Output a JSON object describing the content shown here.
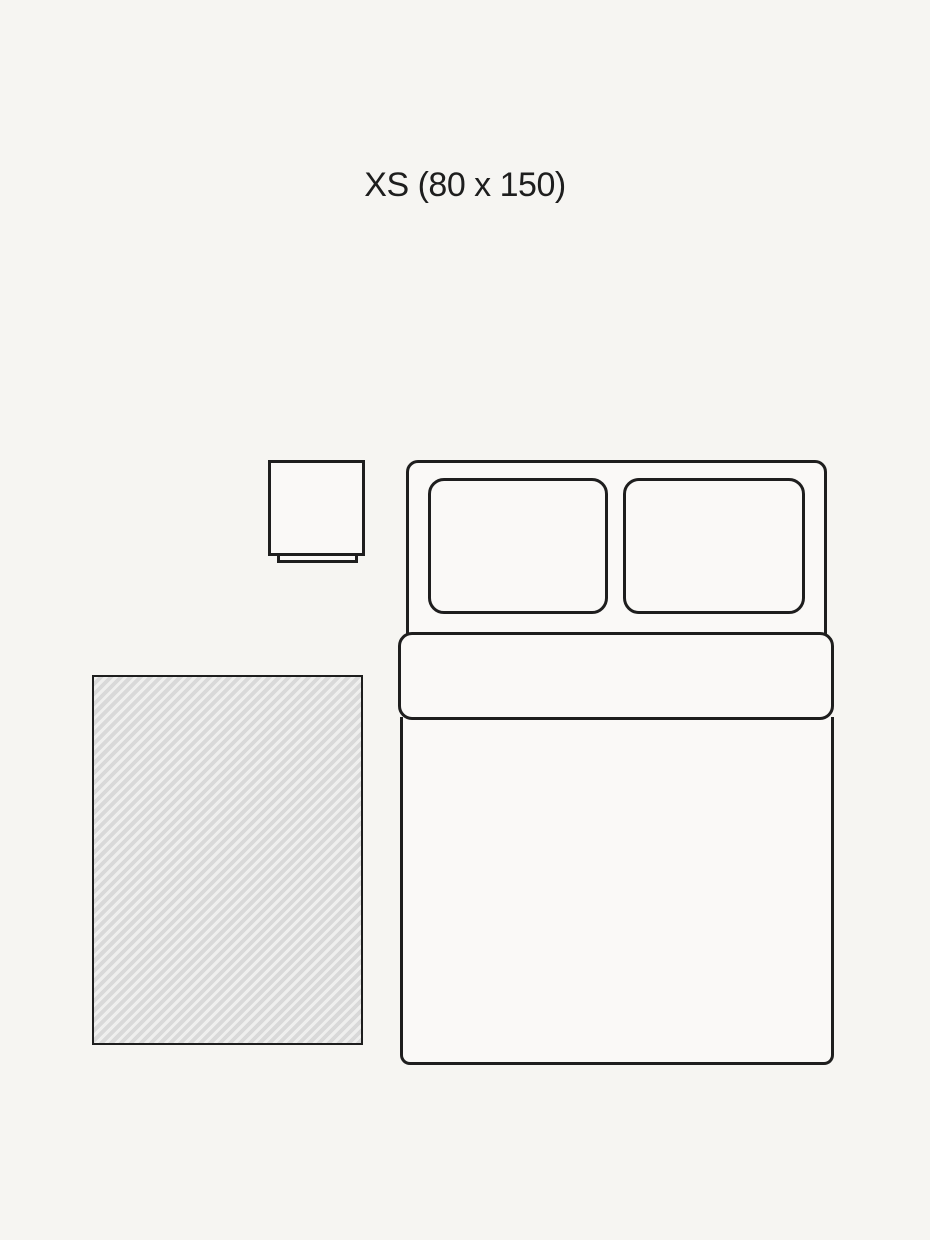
{
  "header": {
    "size_label": "XS (80 x 150)"
  },
  "diagram": {
    "rug_width_cm": 80,
    "rug_length_cm": 150,
    "size_code": "XS",
    "elements": [
      "rug",
      "double-bed",
      "nightstand"
    ]
  },
  "colors": {
    "bg": "#f6f5f2",
    "line": "#1e1e1e",
    "shape_fill": "#faf9f7",
    "rug_stripe_light": "#efefee",
    "rug_stripe_dark": "#d9d9d9"
  }
}
